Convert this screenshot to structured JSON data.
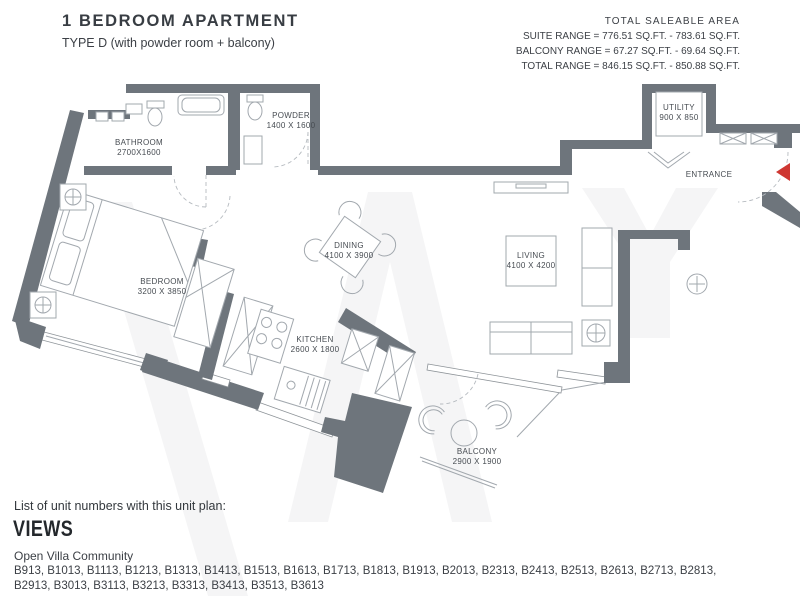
{
  "header": {
    "title": "1 BEDROOM APARTMENT",
    "subtitle": "TYPE D (with powder room + balcony)",
    "area_summary": {
      "heading": "TOTAL SALEABLE AREA",
      "lines": [
        "SUITE RANGE = 776.51 SQ.FT. - 783.61 SQ.FT.",
        "BALCONY RANGE = 67.27 SQ.FT. - 69.64 SQ.FT.",
        "TOTAL RANGE = 846.15 SQ.FT. - 850.88 SQ.FT."
      ]
    }
  },
  "floor_plan": {
    "rooms": [
      {
        "name": "BATHROOM",
        "dimensions": "2700X1600"
      },
      {
        "name": "POWDER",
        "dimensions": "1400 X 1600"
      },
      {
        "name": "UTILITY",
        "dimensions": "900 X 850"
      },
      {
        "name": "ENTRANCE",
        "dimensions": ""
      },
      {
        "name": "BEDROOM",
        "dimensions": "3200 X 3850"
      },
      {
        "name": "DINING",
        "dimensions": "4100 X 3900"
      },
      {
        "name": "LIVING",
        "dimensions": "4100 X 4200"
      },
      {
        "name": "KITCHEN",
        "dimensions": "2600 X 1800"
      },
      {
        "name": "BALCONY",
        "dimensions": "2900 X 1900"
      }
    ],
    "colors": {
      "wall": "#6e757c",
      "furniture_line": "#a2a8ae",
      "label_text": "#474c52",
      "entrance_arrow": "#ce3732",
      "watermark": "#f5f5f6"
    }
  },
  "footer": {
    "list_intro": "List of unit numbers with this unit plan:",
    "views_heading": "VIEWS",
    "community": "Open Villa Community",
    "unit_numbers": "B913, B1013, B1113, B1213, B1313, B1413, B1513, B1613, B1713, B1813, B1913, B2013, B2313, B2413, B2513, B2613, B2713, B2813, B2913, B3013, B3113, B3213, B3313, B3413, B3513, B3613"
  }
}
